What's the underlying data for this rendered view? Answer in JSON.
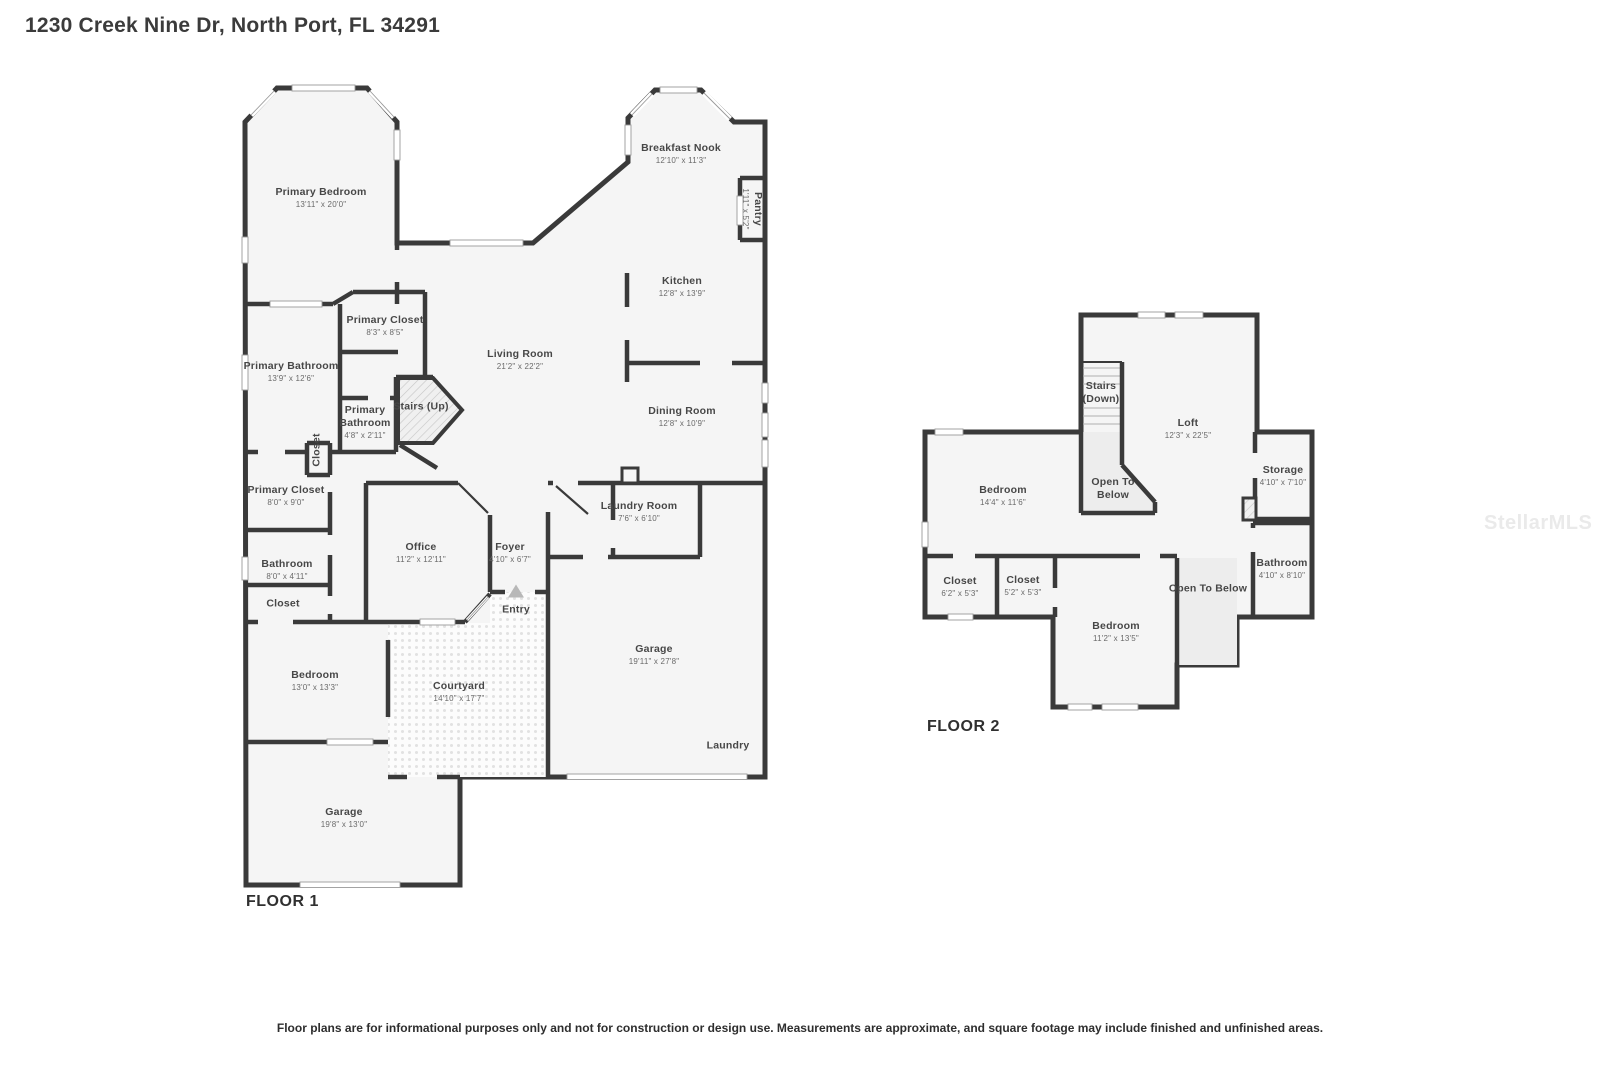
{
  "title": "1230 Creek Nine Dr, North Port, FL 34291",
  "watermark": "StellarMLS",
  "disclaimer": "Floor plans are for informational purposes only and not for construction or design use. Measurements are approximate, and square footage may include finished and unfinished areas.",
  "colors": {
    "wall": "#3a3a3a",
    "floor": "#f5f5f5",
    "entry_marker": "#b8b8b8"
  },
  "icons": {
    "entry-direction-icon": "up-triangle"
  },
  "floor1": {
    "label": "FLOOR 1",
    "rooms": [
      {
        "name": "Primary Bedroom",
        "dims": "13'11\" x 20'0\""
      },
      {
        "name": "Breakfast Nook",
        "dims": "12'10\" x 11'3\""
      },
      {
        "name": "Pantry",
        "dims": "1'11\" x 5'2\""
      },
      {
        "name": "Kitchen",
        "dims": "12'8\" x 13'9\""
      },
      {
        "name": "Primary Closet",
        "dims": "8'3\" x 8'5\""
      },
      {
        "name": "Living Room",
        "dims": "21'2\" x 22'2\""
      },
      {
        "name": "Primary Bathroom",
        "dims": "13'9\" x 12'6\""
      },
      {
        "name": "Stairs (Up)",
        "dims": ""
      },
      {
        "name": "Primary Bathroom",
        "dims": "4'8\" x 2'11\""
      },
      {
        "name": "Dining Room",
        "dims": "12'8\" x 10'9\""
      },
      {
        "name": "Closet",
        "dims": ""
      },
      {
        "name": "Primary Closet",
        "dims": "8'0\" x 9'0\""
      },
      {
        "name": "Laundry Room",
        "dims": "7'6\" x 6'10\""
      },
      {
        "name": "Office",
        "dims": "11'2\" x 12'11\""
      },
      {
        "name": "Foyer",
        "dims": "4'10\" x 6'7\""
      },
      {
        "name": "Bathroom",
        "dims": "8'0\" x 4'11\""
      },
      {
        "name": "Closet",
        "dims": ""
      },
      {
        "name": "Entry",
        "dims": ""
      },
      {
        "name": "Garage",
        "dims": "19'11\" x 27'8\""
      },
      {
        "name": "Bedroom",
        "dims": "13'0\" x 13'3\""
      },
      {
        "name": "Courtyard",
        "dims": "14'10\" x 17'7\""
      },
      {
        "name": "Laundry",
        "dims": ""
      },
      {
        "name": "Garage",
        "dims": "19'8\" x 13'0\""
      }
    ]
  },
  "floor2": {
    "label": "FLOOR 2",
    "rooms": [
      {
        "name": "Stairs (Down)",
        "dims": ""
      },
      {
        "name": "Loft",
        "dims": "12'3\" x 22'5\""
      },
      {
        "name": "Bedroom",
        "dims": "14'4\" x 11'6\""
      },
      {
        "name": "Open To Below",
        "dims": ""
      },
      {
        "name": "Storage",
        "dims": "4'10\" x 7'10\""
      },
      {
        "name": "Closet",
        "dims": "6'2\" x 5'3\""
      },
      {
        "name": "Closet",
        "dims": "5'2\" x 5'3\""
      },
      {
        "name": "Bathroom",
        "dims": "4'10\" x 8'10\""
      },
      {
        "name": "Open To Below",
        "dims": ""
      },
      {
        "name": "Bedroom",
        "dims": "11'2\" x 13'5\""
      }
    ]
  }
}
